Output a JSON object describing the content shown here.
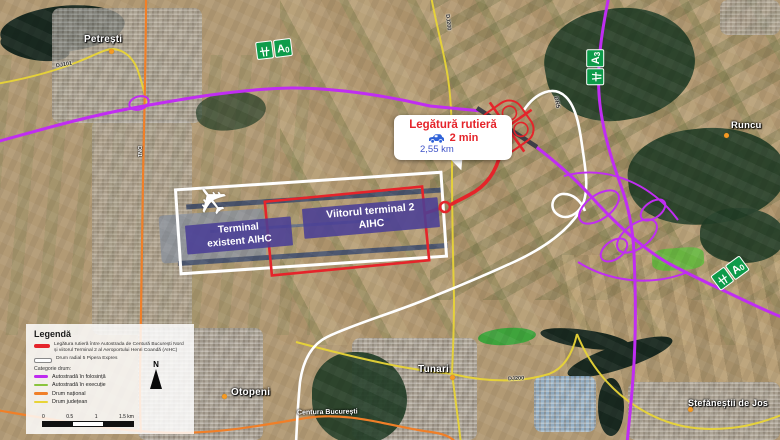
{
  "towns": [
    {
      "name": "Petrești"
    },
    {
      "name": "Runcu"
    },
    {
      "name": "Tunari"
    },
    {
      "name": "Otopeni"
    },
    {
      "name": "Ștefăneștii de Jos"
    }
  ],
  "road_labels": {
    "dj101": "DJ101",
    "dn1": "DN1",
    "dj200_north": "DJ200",
    "dj200_east": "DJ200",
    "dr5": "DR5",
    "centura": "Centura București"
  },
  "signs": {
    "a0": "A",
    "a0_sub": "0",
    "a3": "A",
    "a3_sub": "3"
  },
  "terminals": {
    "existing_line1": "Terminal",
    "existing_line2": "existent AIHC",
    "future_line1": "Viitorul terminal 2",
    "future_line2": "AIHC"
  },
  "callout": {
    "title": "Legătură rutieră",
    "time": "2 min",
    "distance": "2,55 km"
  },
  "legend": {
    "title": "Legendă",
    "item_link_line1": "Legătura rutieră între Autostrada de Centură București Nord",
    "item_link_line2": "și viitorul Terminal 2 al Aeroportului Henri Coandă (AIHC)",
    "item_radial": "Drum radial 5 Pipera Expres",
    "category_title": "Categorie drum:",
    "categories": [
      {
        "label": "Autostradă în folosință",
        "color": "#bf2af0"
      },
      {
        "label": "Autostradă în execuție",
        "color": "#8ac43e"
      },
      {
        "label": "Drum național",
        "color": "#f07f28"
      },
      {
        "label": "Drum județean",
        "color": "#e8d437"
      }
    ],
    "north_label": "N",
    "scale_ticks": [
      "0",
      "0.5",
      "1",
      "1.5 km"
    ]
  },
  "colors": {
    "route_red": "#e5242a",
    "motorway_purple": "#c02df2",
    "motorway_green": "#8ac43e",
    "national_orange": "#f07f28",
    "county_yellow": "#e8d437",
    "radial_white": "#ffffff",
    "sign_green": "#0d9b4a",
    "area_label_indigo": "#4a3f96",
    "callout_blue": "#4054c8"
  }
}
